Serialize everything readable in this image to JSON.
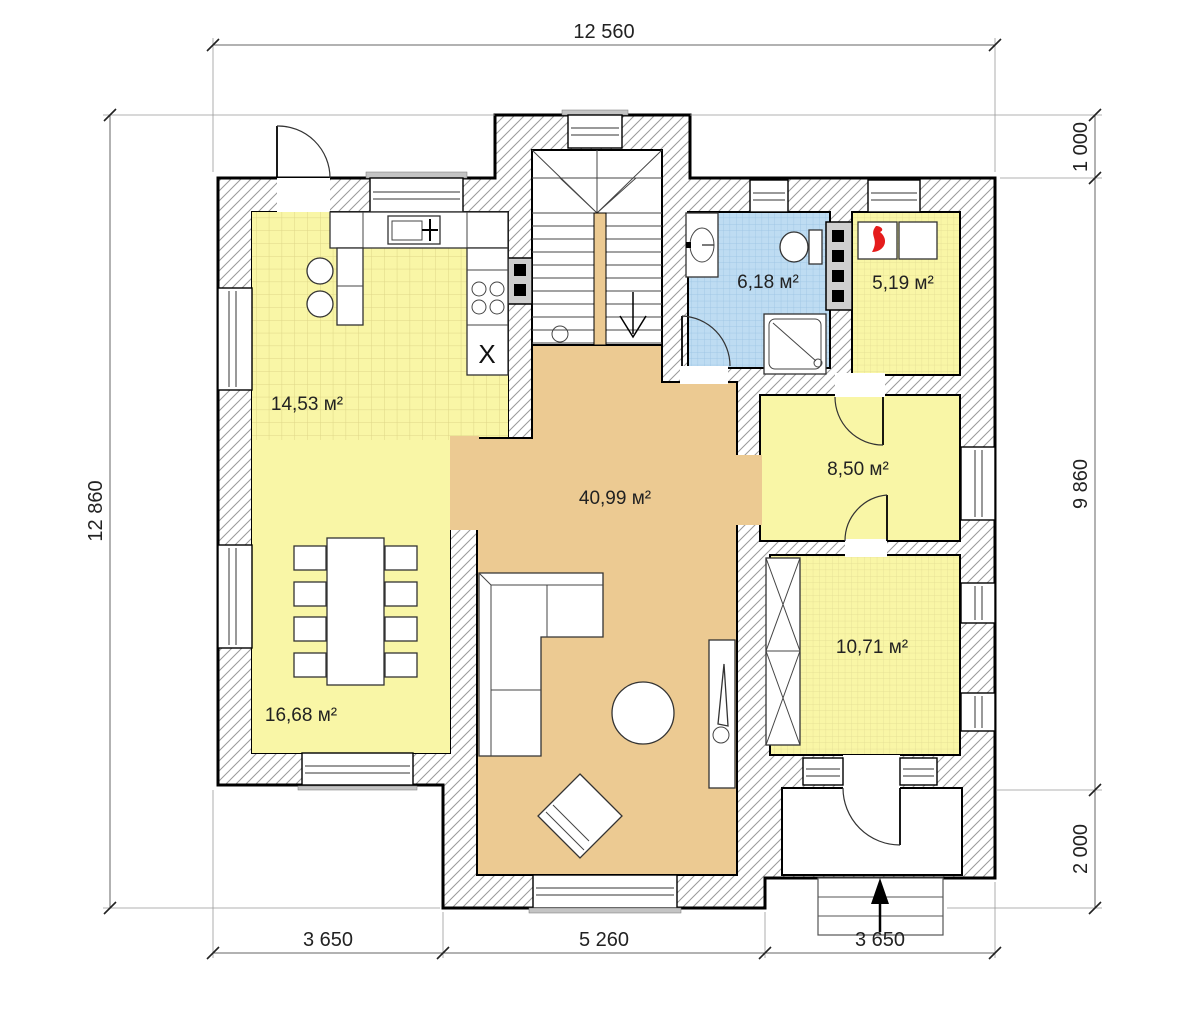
{
  "floor_plan": {
    "rooms": [
      {
        "name": "kitchen",
        "area": "14,53 м²"
      },
      {
        "name": "bathroom",
        "area": "6,18 м²"
      },
      {
        "name": "boiler-room",
        "area": "5,19 м²"
      },
      {
        "name": "hall",
        "area": "8,50 м²"
      },
      {
        "name": "living-room",
        "area": "40,99 м²"
      },
      {
        "name": "dining-room",
        "area": "16,68 м²"
      },
      {
        "name": "bedroom",
        "area": "10,71 м²"
      }
    ],
    "dimensions": {
      "top_width": "12 560",
      "left_height": "12 860",
      "right_top": "1 000",
      "right_main": "9 860",
      "right_bottom": "2 000",
      "bottom_left": "3 650",
      "bottom_center": "5 260",
      "bottom_right": "3 650"
    },
    "markers": {
      "appliance_x": "X"
    },
    "colors": {
      "room_yellow": "#f9f6a6",
      "room_blue": "#bedcf2",
      "room_tan": "#ecca92",
      "wall_hatch_line": "#9a9a9a",
      "flame_red": "#e51c1c"
    }
  }
}
